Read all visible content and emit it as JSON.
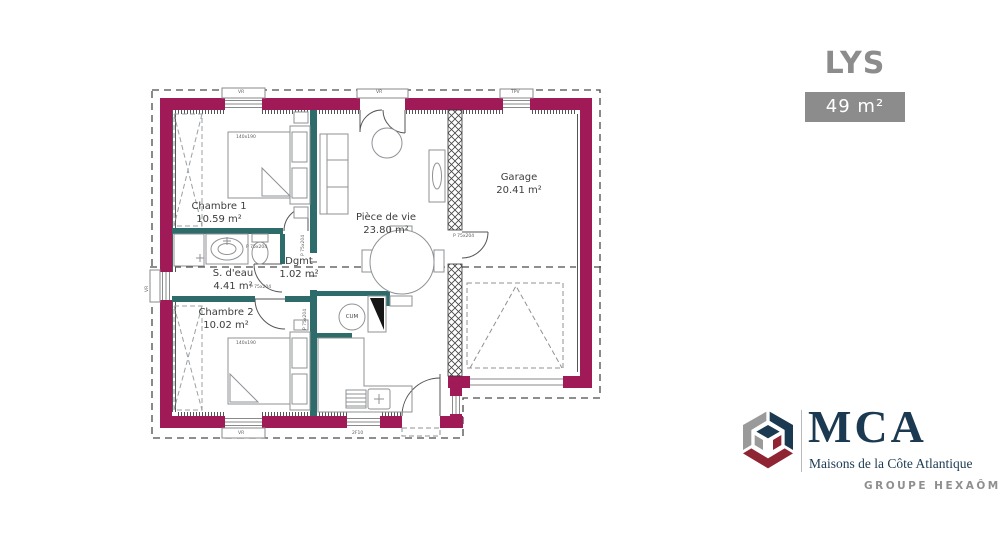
{
  "header": {
    "plan_name": "LYS",
    "area_badge": "49 m²"
  },
  "rooms": [
    {
      "name": "Chambre 1",
      "area": "10.59 m²"
    },
    {
      "name": "S. d'eau",
      "area": "4.41 m²"
    },
    {
      "name": "Chambre 2",
      "area": "10.02 m²"
    },
    {
      "name": "Dgmt",
      "area": "1.02 m²"
    },
    {
      "name": "Pièce de vie",
      "area": "23.80 m²"
    },
    {
      "name": "Garage",
      "area": "20.41 m²"
    }
  ],
  "annotations": {
    "water_heater": "CUM",
    "bed_size": "140x190",
    "interior_door_code": "P 75x204",
    "roller_shutter_code": "VR",
    "garage_window_code": "TPV",
    "kitchen_window_code": "2F10"
  },
  "branding": {
    "logo_monogram": "MCA",
    "logo_subtitle": "Maisons de la Côte Atlantique",
    "group_name": "GROUPE HEXAÔM"
  },
  "colors": {
    "exterior_wall": "#A01A58",
    "interior_wall": "#2E6B6B",
    "plan_line": "#4A4A4A",
    "furniture_line": "#8E9296",
    "label_text": "#3D3D3D",
    "title_gray": "#8C8C8C",
    "badge_bg": "#8C8C8C",
    "brand_navy": "#1B3A52",
    "brand_red": "#8F2433",
    "brand_gray": "#9A9A9A",
    "group_text": "#8F8F8F"
  }
}
